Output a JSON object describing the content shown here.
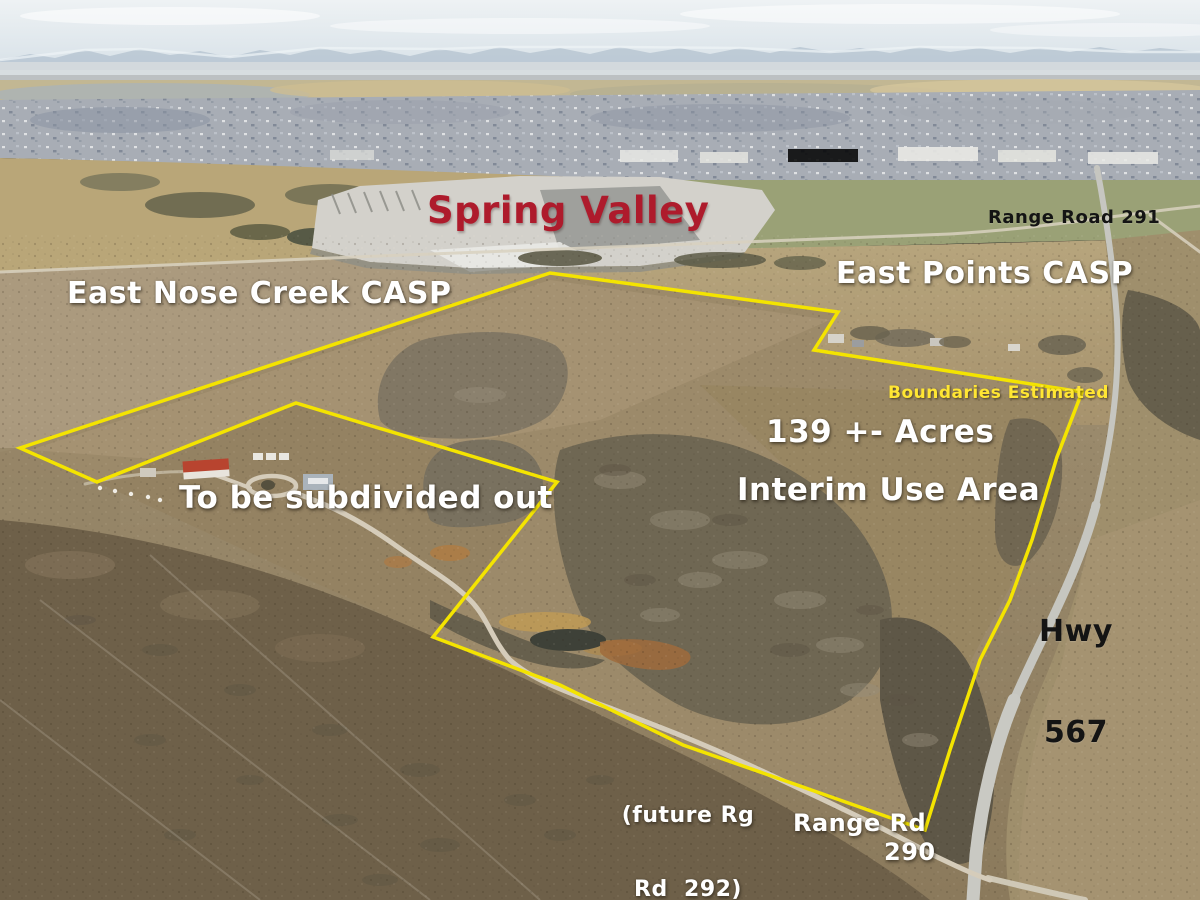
{
  "annotations": {
    "spring_valley": "Spring Valley",
    "range_road_291": "Range Road 291",
    "east_nose_creek_casp": "East Nose Creek CASP",
    "east_points_casp": "East Points CASP",
    "boundaries_estimated": "Boundaries Estimated",
    "acreage": "139 +- Acres",
    "interim_use_area": "Interim Use Area",
    "to_be_subdivided": "To be subdivided out",
    "hwy": {
      "line1": "Hwy",
      "line2": "567"
    },
    "future_range_road": {
      "line1": "(future Rg",
      "line2": "Rd  292)"
    },
    "range_rd_290": {
      "line1": "Range Rd",
      "line2": "290"
    }
  },
  "colors": {
    "boundary_line": "#f4e400",
    "spring_valley_text": "#ae1b2c",
    "white_text": "#ffffff",
    "black_text": "#141414",
    "estimate_text": "#ffe633"
  },
  "boundary": {
    "points": "20,448 550,273 838,312 814,350 1082,392 1057,457 1032,540 1010,600 980,660 950,750 925,830 800,786 683,745 560,685 433,637 557,482 296,403 97,482"
  }
}
